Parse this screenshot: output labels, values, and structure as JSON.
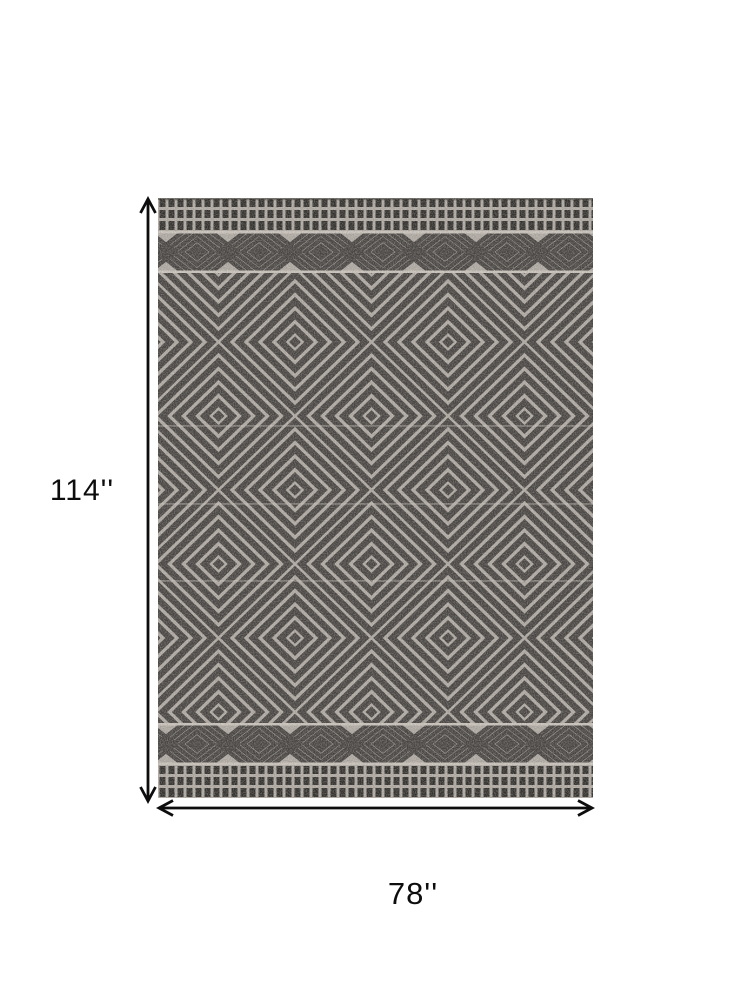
{
  "image_type": "product-dimension-diagram",
  "product": {
    "description": "Rectangular area rug with tribal geometric pattern: concentric diamond lattice field, diamond-eye motif bands and dashed stripe borders at top and bottom",
    "colors": {
      "background": "#ffffff",
      "rug_field_light": "#b0aaa3",
      "rug_pattern_dark": "#454240",
      "rug_border_dark": "#2f2d2a",
      "rug_seam_light": "#cac4bc",
      "annotation_black": "#0d0d0d"
    }
  },
  "dimensions": {
    "height_label": "114''",
    "width_label": "78''"
  }
}
